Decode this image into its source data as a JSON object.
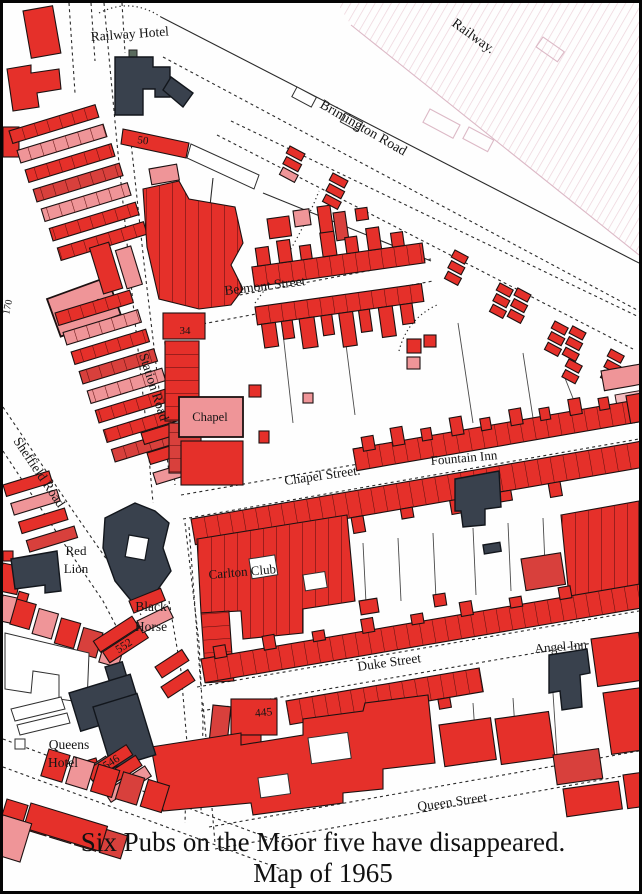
{
  "caption": {
    "line1": "Six Pubs on the Moor five have disappeared.",
    "line2": "Map of 1965"
  },
  "streets": {
    "railway": "Railway.",
    "brimington": "Brimington Road",
    "belmont": "Belmont Street",
    "station": "Station Road",
    "sheffield": "Sheffield Road",
    "chapel": "Chapel Street.",
    "duke": "Duke Street",
    "queen": "Queen Street"
  },
  "pubs": {
    "railway_hotel": "Railway Hotel",
    "red_lion": [
      "Red",
      "Lion"
    ],
    "black_horse": [
      "Black",
      "Horse"
    ],
    "queens_hotel": [
      "Queens",
      "Hotel"
    ],
    "fountain_inn": "Fountain Inn",
    "angel_inn": "Angel Inn"
  },
  "places": {
    "carlton_club": "Carlton Club",
    "chapel_west": "Chapel",
    "chapel_east": "Chapel"
  },
  "numbers": {
    "n50": "50",
    "n34": "34",
    "n170": "170",
    "n552": "552",
    "n546": "546",
    "n445": "445"
  },
  "colors": {
    "building_red": "#e5302a",
    "building_pink": "#ef9598",
    "pub_dark": "#39414d",
    "railway_hatch": "#ecd2da",
    "ink": "#151515"
  }
}
